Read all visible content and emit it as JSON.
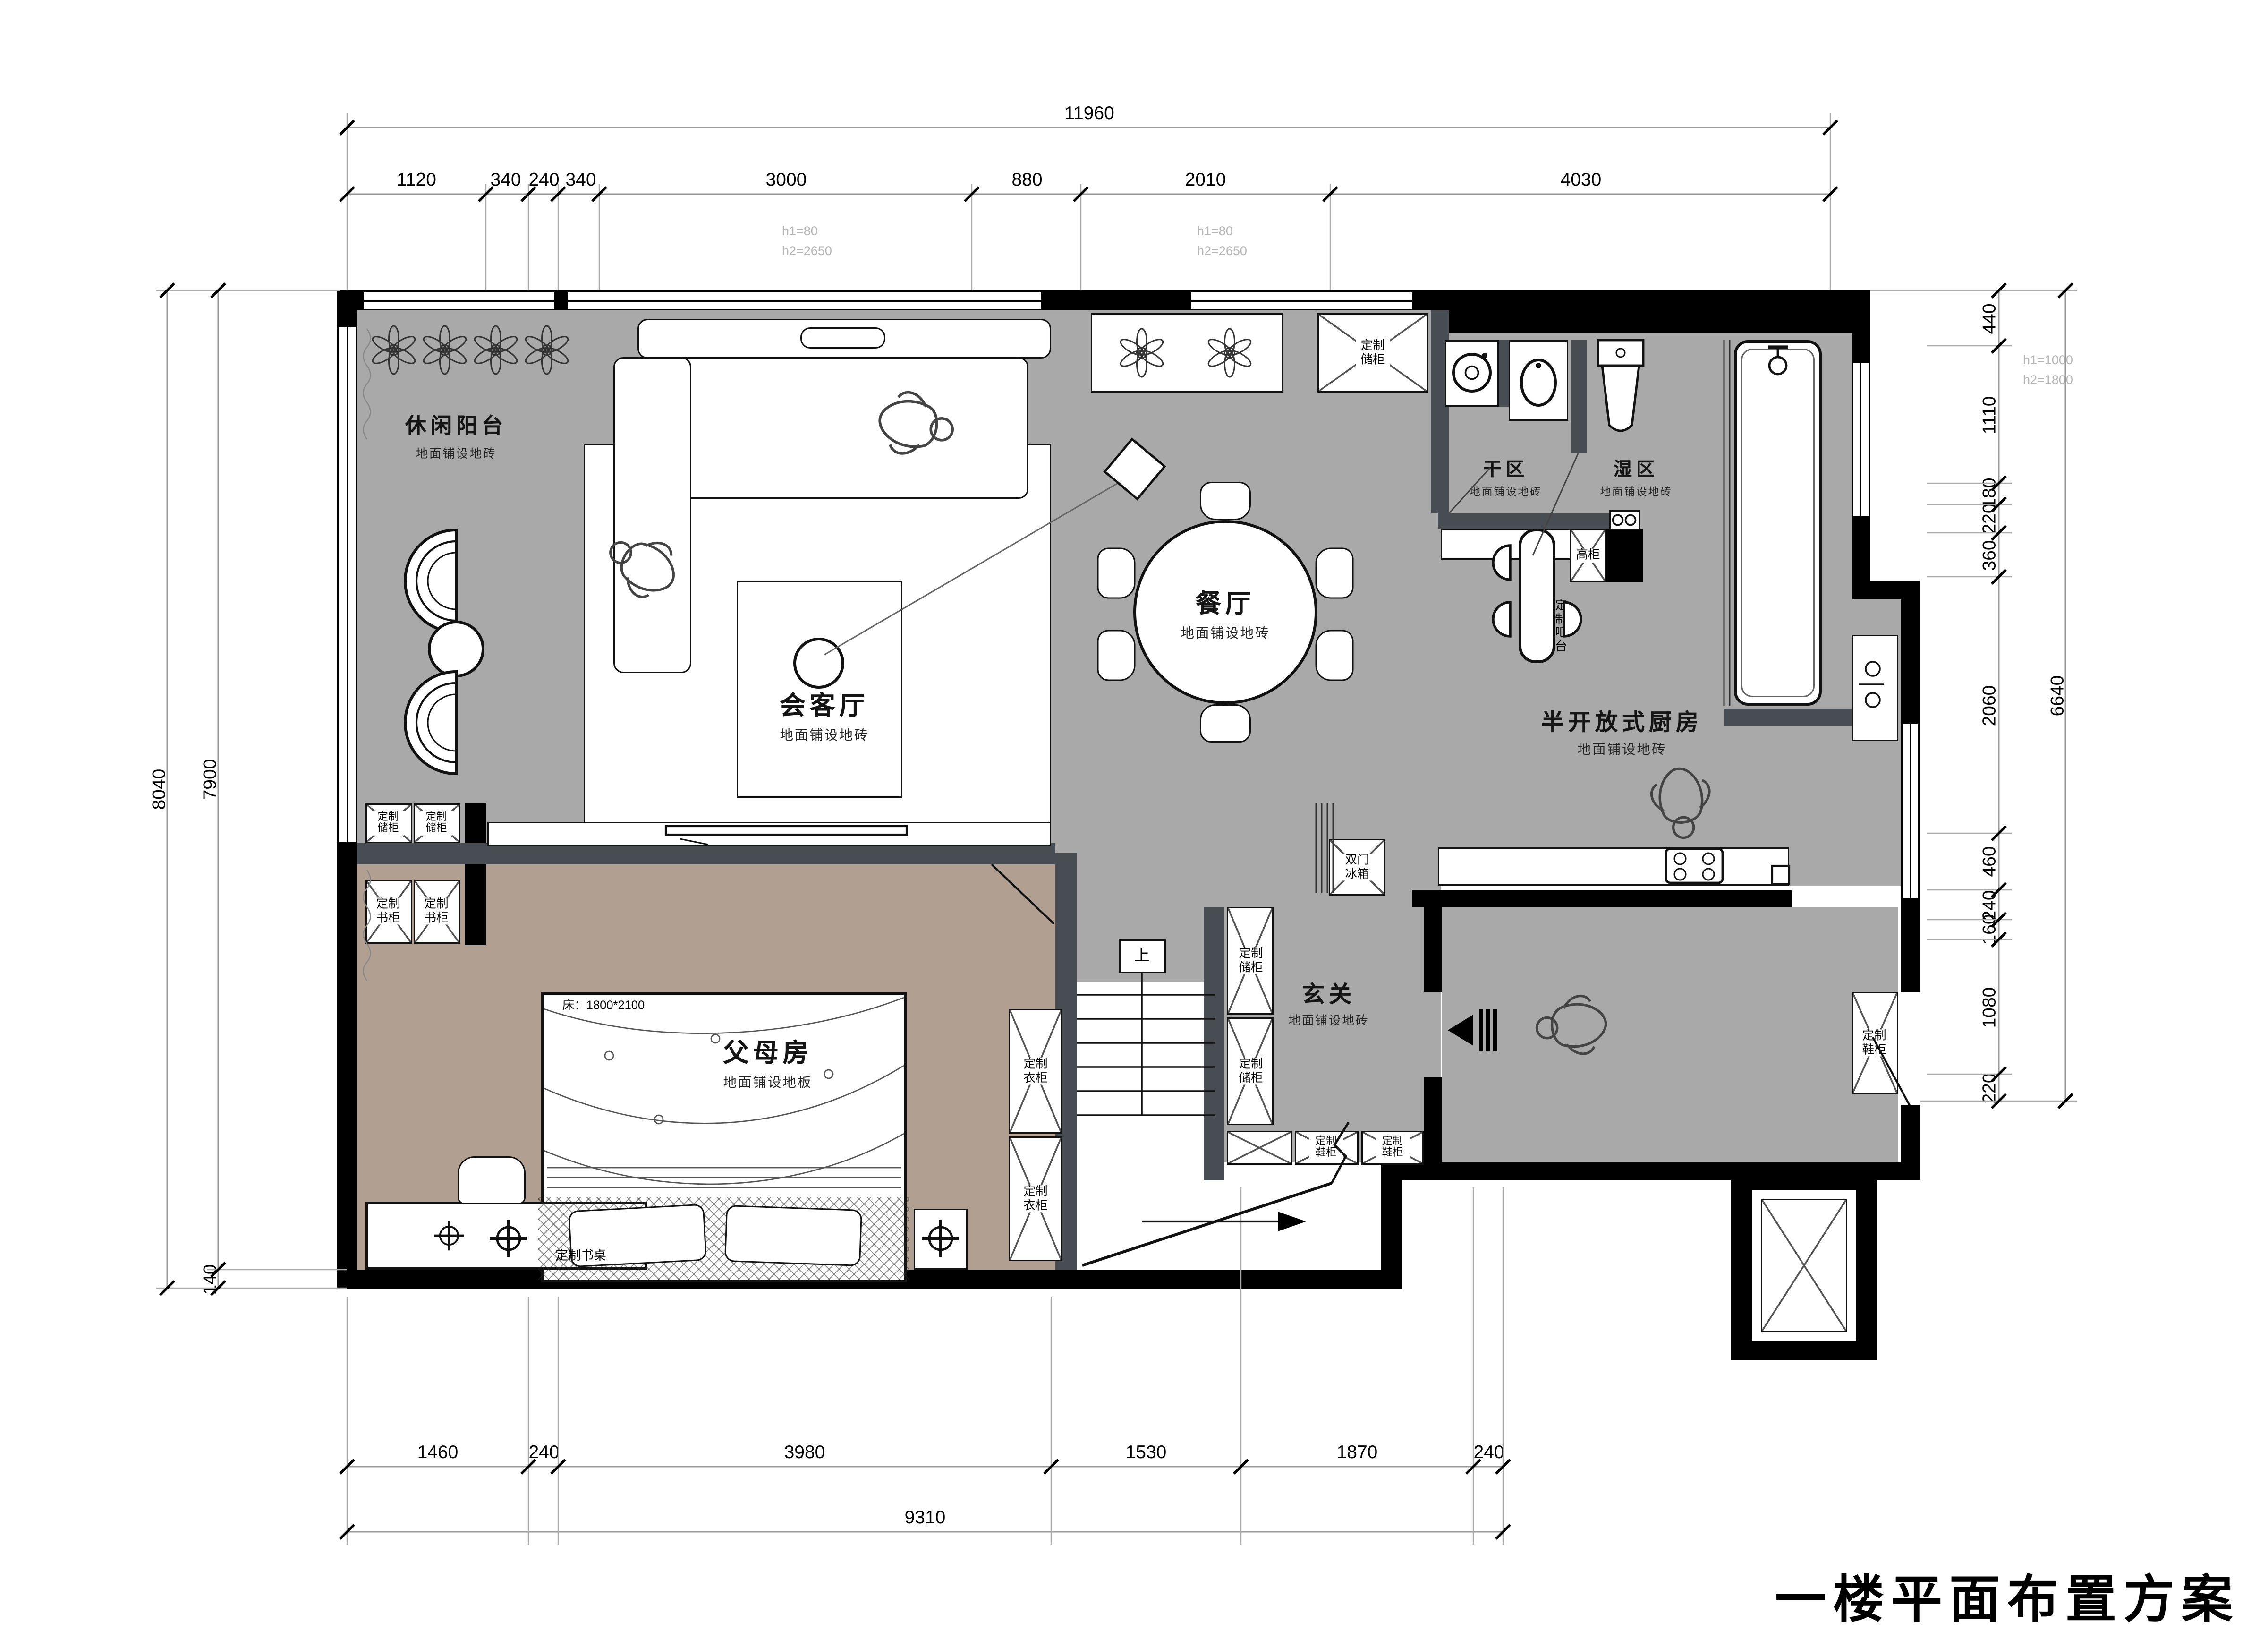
{
  "title": "一楼平面布置方案",
  "colors": {
    "floor_tile_gray": "#a9a9a9",
    "floor_wood_warm": "#b1a092",
    "wall_black": "#000000",
    "partition_dark": "#474d52",
    "note_gray": "#b5b5b5"
  },
  "rooms": {
    "balcony": {
      "name": "休闲阳台",
      "note": "地面铺设地砖"
    },
    "living": {
      "name": "会客厅",
      "note": "地面铺设地砖"
    },
    "dining": {
      "name": "餐厅",
      "note": "地面铺设地砖"
    },
    "dry": {
      "name": "干区",
      "note": "地面铺设地砖"
    },
    "wet": {
      "name": "湿区",
      "note": "地面铺设地砖"
    },
    "kitchen": {
      "name": "半开放式厨房",
      "note": "地面铺设地砖"
    },
    "foyer": {
      "name": "玄关",
      "note": "地面铺设地砖"
    },
    "master": {
      "name": "父母房",
      "note": "地面铺设地板"
    }
  },
  "cabinets": {
    "storage": "定制储柜",
    "bookcase": "定制书柜",
    "wardrobe": "定制衣柜",
    "shoe": "定制鞋柜",
    "tall": "高柜",
    "bar": "定制吧台",
    "fridge": "双门冰箱",
    "desk": "定制书桌"
  },
  "labels": {
    "stair_up": "上",
    "bed_size": "床：1800*2100"
  },
  "window_notes": {
    "left1": "h1=80",
    "left2": "h2=2650",
    "mid1": "h1=80",
    "mid2": "h2=2650",
    "right1": "h1=1000",
    "right2": "h2=1800"
  },
  "dimensions": {
    "top_total": "11960",
    "top": [
      "1120",
      "340",
      "240",
      "340",
      "3000",
      "880",
      "2010",
      "4030"
    ],
    "bottom": [
      "1460",
      "240",
      "3980",
      "1530",
      "1870",
      "240"
    ],
    "bottom_total": "9310",
    "left": [
      "8040",
      "7900",
      "140"
    ],
    "right": [
      "440",
      "1110",
      "180",
      "220",
      "360",
      "2060",
      "460",
      "240",
      "160",
      "1080",
      "220"
    ],
    "right_total": "6640"
  }
}
